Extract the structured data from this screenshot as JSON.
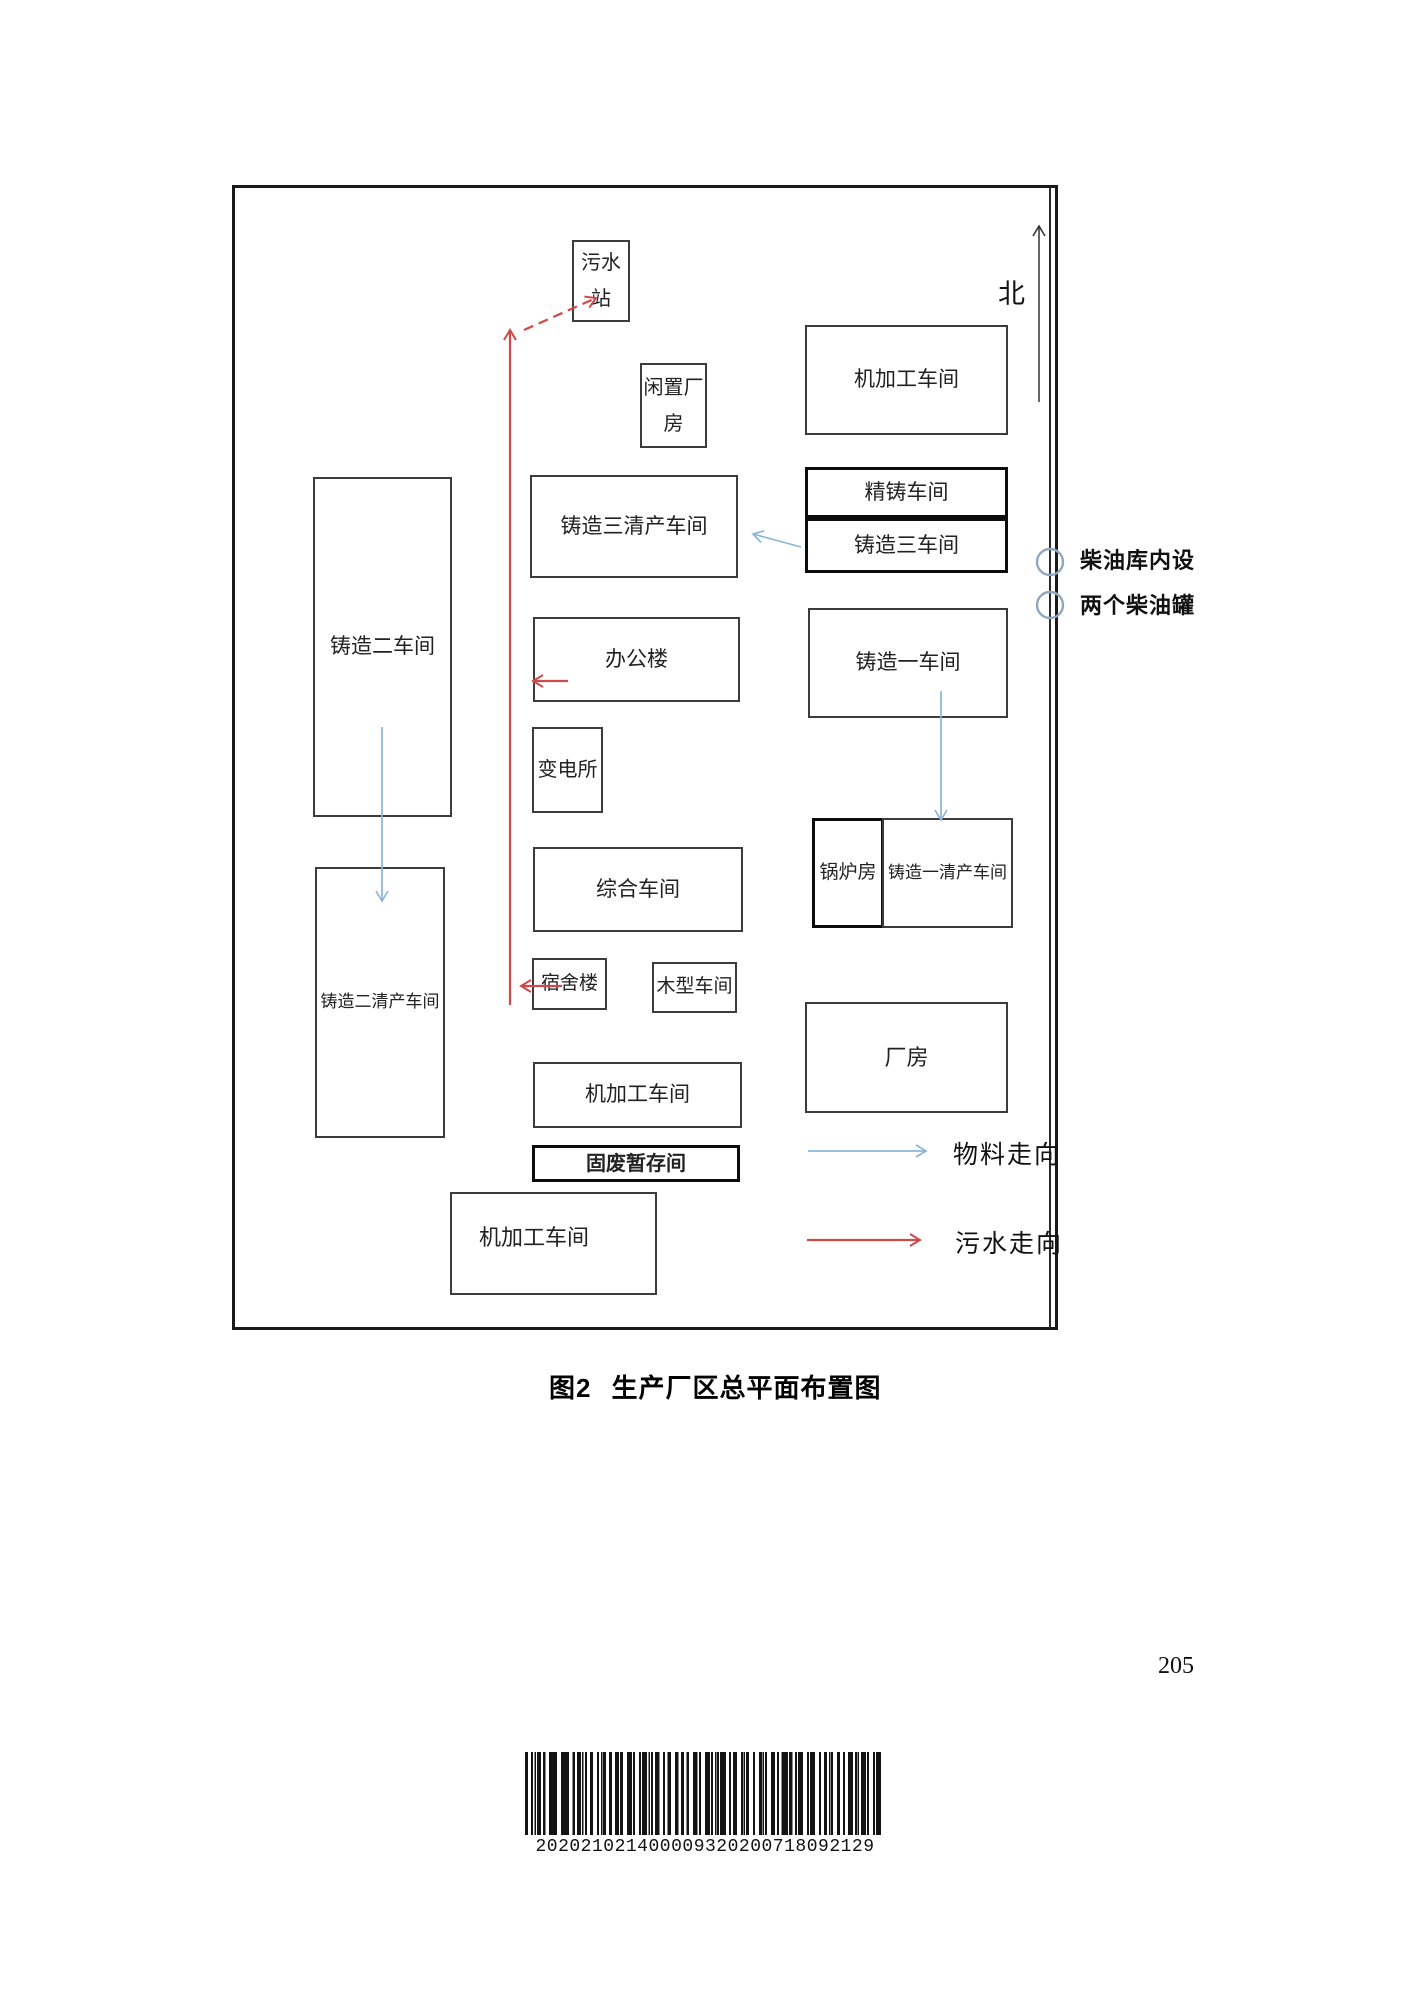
{
  "caption": {
    "prefix": "图2",
    "title": "生产厂区总平面布置图"
  },
  "page_number": "205",
  "barcode": {
    "digits": "202021021400009320200718092129"
  },
  "compass": {
    "north_label": "北"
  },
  "legend": {
    "material_flow": "物料走向",
    "sewage_flow": "污水走向"
  },
  "annotations": {
    "diesel_line1": "柴油库内设",
    "diesel_line2": "两个柴油罐"
  },
  "buildings": {
    "sewage_station": "污水站",
    "idle_plant": "闲置厂房",
    "machining_north": "机加工车间",
    "precision_casting": "精铸车间",
    "casting3": "铸造三车间",
    "casting3_cleaning": "铸造三清产车间",
    "casting2": "铸造二车间",
    "office": "办公楼",
    "substation": "变电所",
    "casting1": "铸造一车间",
    "comprehensive": "综合车间",
    "boiler": "锅炉房",
    "casting1_cleaning": "铸造一清产车间",
    "casting2_cleaning": "铸造二清产车间",
    "dormitory": "宿舍楼",
    "wood_pattern": "木型车间",
    "machining_middle": "机加工车间",
    "solid_waste": "固废暂存间",
    "machining_south": "机加工车间",
    "plant_building": "厂房"
  },
  "colors": {
    "sewage_arrow": "#cf4a4a",
    "material_arrow": "#8ab6d6",
    "frame": "#1a1a1a",
    "diesel_tank_circle": "#8ea7bf"
  }
}
